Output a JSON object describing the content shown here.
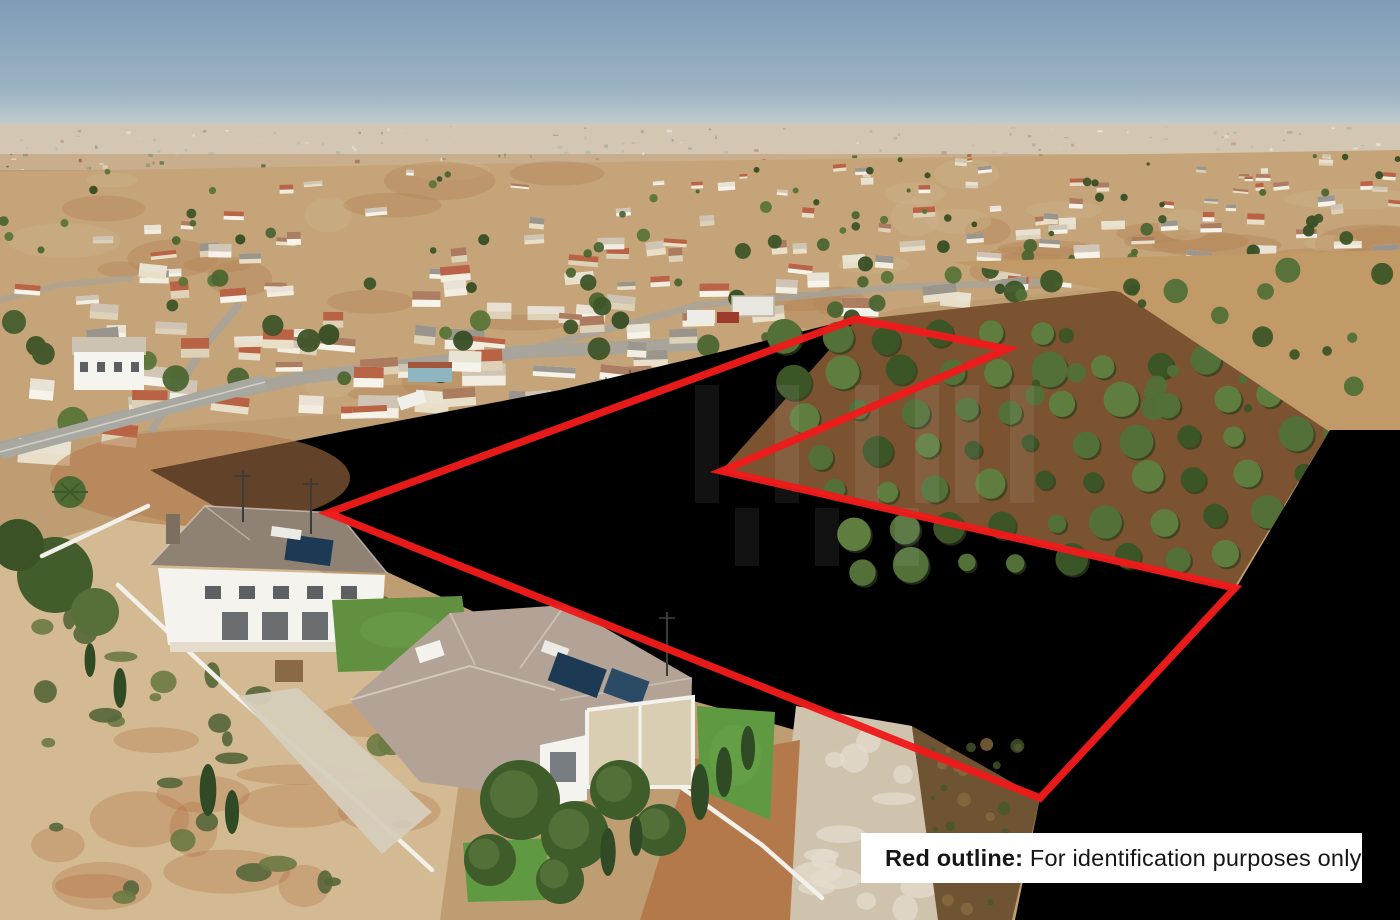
{
  "meta": {
    "kind": "aerial-drone-photo",
    "width": 1400,
    "height": 920
  },
  "overlay": {
    "disclaimer": {
      "bold": "Red outline:",
      "text": " For identification purposes only",
      "bg": "#ffffff",
      "color": "#161616"
    },
    "outline": {
      "color": "#ee1b1b",
      "stroke_width": 7.5,
      "points": [
        [
          328,
          513
        ],
        [
          856,
          319
        ],
        [
          1007,
          349
        ],
        [
          722,
          471
        ],
        [
          1235,
          588
        ],
        [
          1040,
          798
        ]
      ]
    },
    "watermark": {
      "present": true,
      "color": "#ffffff",
      "opacity": 0.07
    }
  },
  "scene": {
    "sky": {
      "top": "#7e9db8",
      "mid": "#9db3c3",
      "horizon": "#c6cfd0",
      "horizon_y": 124
    },
    "distant": {
      "base": "#c9ae8d",
      "speck_colors": [
        "#ece7da",
        "#a4683f",
        "#5a6b44",
        "#c8b694",
        "#8d9a72"
      ]
    },
    "ground": {
      "base": "#bf9d72 "
    },
    "village": {
      "base": "#c4a478",
      "top_anchors": [
        [
          0,
          172
        ],
        [
          400,
          165
        ],
        [
          900,
          158
        ],
        [
          1400,
          150
        ]
      ],
      "bottom_anchors": [
        [
          0,
          448
        ],
        [
          240,
          420
        ],
        [
          430,
          408
        ],
        [
          600,
          395
        ],
        [
          690,
          372
        ],
        [
          790,
          338
        ],
        [
          900,
          308
        ],
        [
          1080,
          290
        ],
        [
          1250,
          280
        ],
        [
          1400,
          268
        ]
      ],
      "house_walls": [
        "#f2ede1",
        "#e9dfc9",
        "#ddd2b8",
        "#f6f3ea"
      ],
      "house_roofs": [
        "#b65c3d",
        "#cdc3b2",
        "#969189",
        "#e8e2d4",
        "#a9765a"
      ],
      "tree_colors": [
        "#3e5529",
        "#4c6631",
        "#5b7539",
        "#374e24"
      ],
      "road": "#a5a49d"
    },
    "plow_field": {
      "base": "#cbad83",
      "light": "#d9bf97",
      "line": "#ab8d66"
    },
    "orchard": {
      "soil": "#7b5331",
      "tree_dark": "#3c5527",
      "tree_mid": "#527038",
      "tree_light": "#5f7d3e"
    },
    "tan_strip": {
      "base": "#c19a68"
    },
    "orange_field": {
      "base": "#a0612e",
      "streak": "#b5762f",
      "tuft": "#5d7136",
      "dark": "#8a4f24"
    },
    "track": {
      "base": "#cfc3ae",
      "spot": "#e4ddcf"
    },
    "scrub_strip": {
      "base": "#6f5434"
    },
    "scrub": {
      "base": "#d3ba92",
      "bush": "#6b7a43",
      "bush2": "#55663a",
      "dirt": "#b06a3f"
    },
    "foreground": {
      "wall": "#f2f0ea",
      "house_wall": "#f5f3ee",
      "roof_left": "#8f8173",
      "roof_near": "#b2a396",
      "ridge": "#d8cfc4",
      "lawn": "#619140",
      "turf": "#5f9a43",
      "pergola": "#d9cdb2",
      "solar_panel": "#1d3a54",
      "heater": "#eceae4",
      "cypress": "#2f4a24",
      "path": "#d6cdbc",
      "pole": "#3c3c38",
      "dirt_lot": "#b3794a"
    }
  }
}
